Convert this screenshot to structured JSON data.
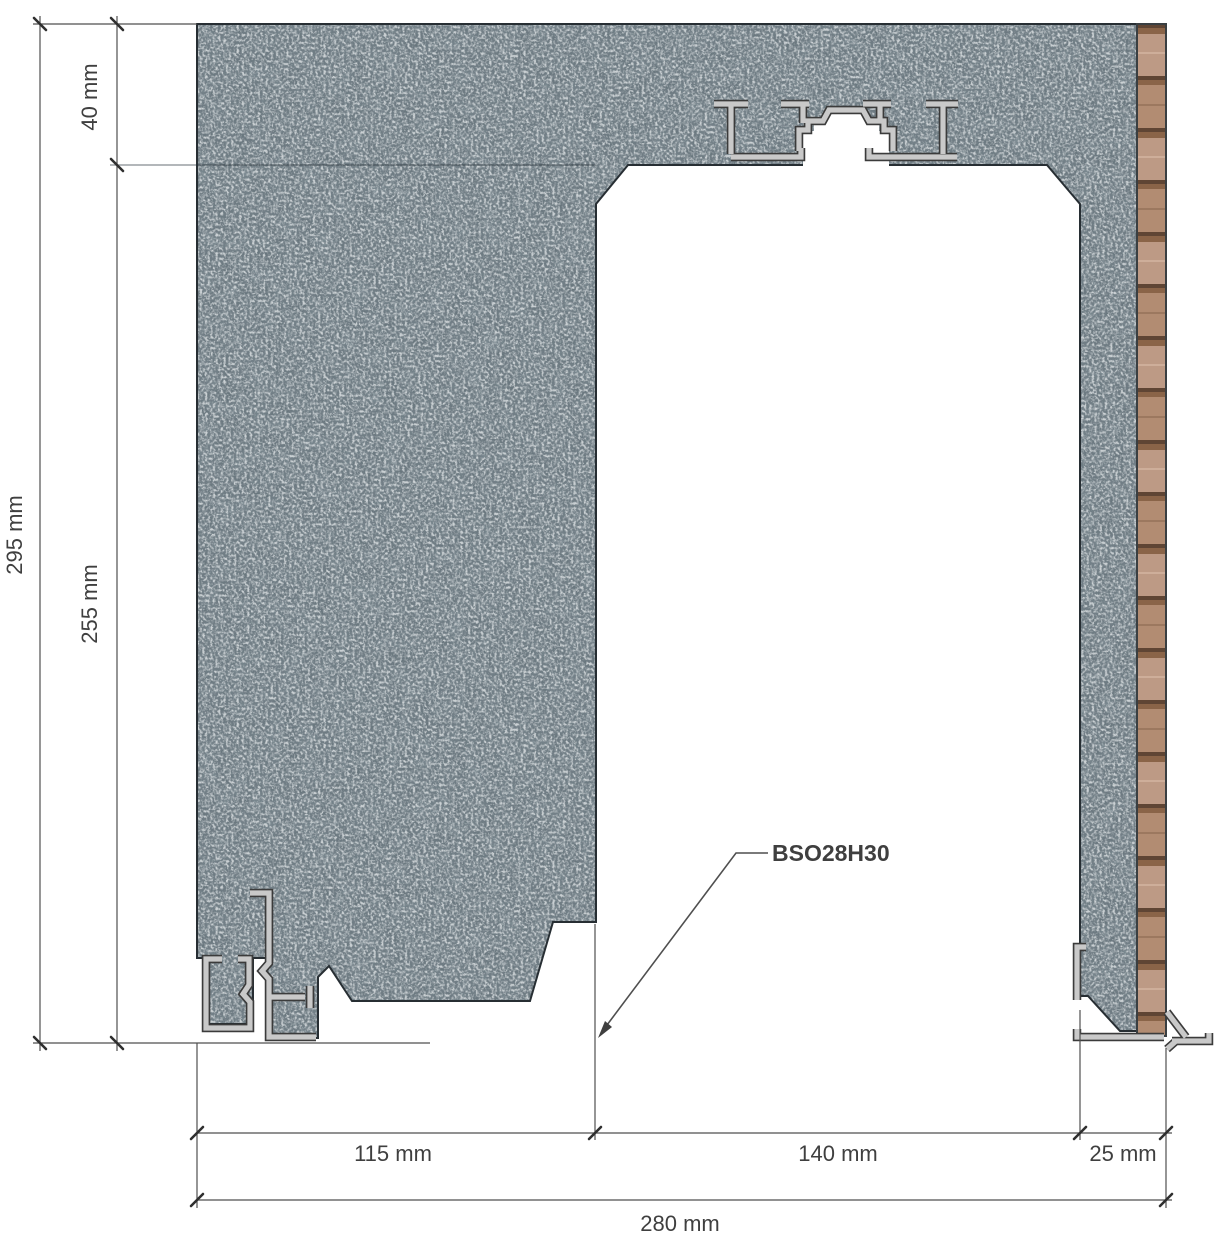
{
  "drawing": {
    "type": "construction cross-section detail",
    "annotation": {
      "profile_label": "BSO28H30"
    },
    "dimensions": {
      "top_offset": "40 mm",
      "overall_height": "295 mm",
      "lower_height": "255 mm",
      "left_jamb_width": "115 mm",
      "opening_width": "140 mm",
      "right_jamb_width": "25 mm",
      "overall_width": "280 mm"
    },
    "colors": {
      "masonry": "#68767d",
      "masonry_dark_speckle": "#2c363c",
      "masonry_light_speckle": "#97a1a5",
      "wood_plank": "#bd9a85",
      "wood_plank_alt": "#b28c72",
      "wood_separator": "#8a6448",
      "wood_line": "#5f4534",
      "aluminum": "#c9c9c9",
      "aluminum_edge": "#3b3b3b",
      "outline": "#272e33",
      "dimension_line": "#4f4f4f",
      "tick": "#2f2f2f",
      "text": "#3f3f3f"
    }
  }
}
